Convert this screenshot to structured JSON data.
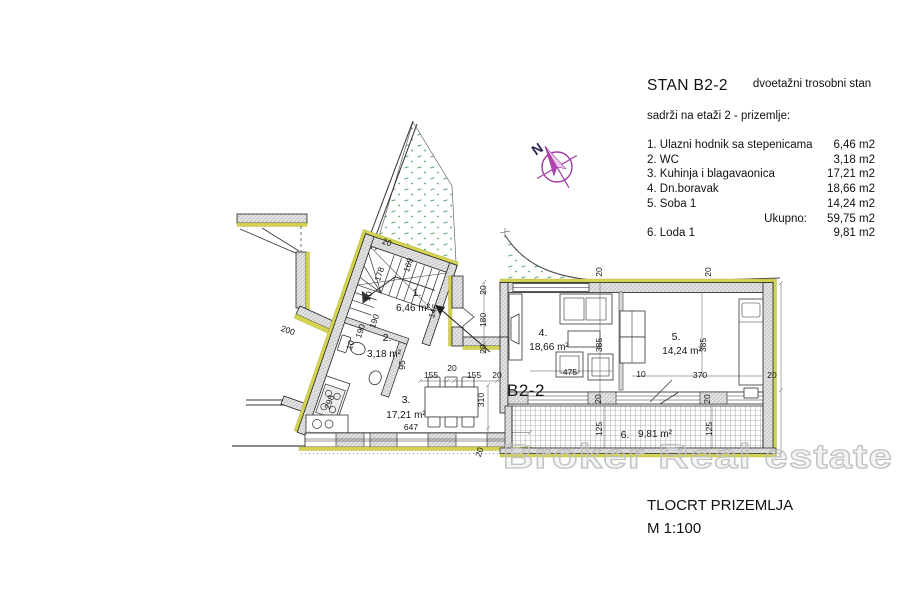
{
  "legend": {
    "title": "STAN B2-2",
    "subtitle": "dvoetažni trosobni stan",
    "intro": "sadrži na etaži 2 - prizemlje:",
    "items": [
      {
        "label": "1. Ulazni hodnik sa stepenicama",
        "mid": "",
        "area": "6,46 m2"
      },
      {
        "label": "2. WC",
        "mid": "",
        "area": "3,18 m2"
      },
      {
        "label": "3. Kuhinja i blagavaonica",
        "mid": "",
        "area": "17,21 m2"
      },
      {
        "label": "4. Dn.boravak",
        "mid": "",
        "area": "18,66 m2"
      },
      {
        "label": "5. Soba 1",
        "mid": "",
        "area": "14,24 m2"
      },
      {
        "label": "",
        "mid": "Ukupno:",
        "area": "59,75 m2"
      },
      {
        "label": "6. Loda 1",
        "mid": "",
        "area": "9,81 m2"
      }
    ]
  },
  "plan": {
    "unit_label": "B2-2",
    "compass": "N",
    "rooms": [
      {
        "num": "1.",
        "area": "6,46 m²"
      },
      {
        "num": "2.",
        "area": "3,18 m²"
      },
      {
        "num": "3.",
        "area": "17,21 m²"
      },
      {
        "num": "4.",
        "area": "18,66 m²"
      },
      {
        "num": "5.",
        "area": "14,24 m²"
      },
      {
        "num": "6.",
        "area": "9,81 m²"
      }
    ],
    "dims": [
      "20",
      "169",
      "178",
      "10",
      "190",
      "190",
      "10",
      "146",
      "95",
      "20",
      "20",
      "20",
      "180",
      "20",
      "155",
      "20",
      "155",
      "20",
      "310",
      "647",
      "475",
      "385",
      "385",
      "370",
      "10",
      "20",
      "20",
      "20",
      "125",
      "125",
      "298",
      "200",
      "20"
    ]
  },
  "watermark": "Broker Real estate",
  "footer": {
    "title": "TLOCRT PRIZEMLJA",
    "scale": "M 1:100"
  },
  "colors": {
    "accent_yellow": "#d3d34f",
    "vegetation_green": "#58a268",
    "compass_magenta": "#a23aa2",
    "wall_gray": "#e0e0e0",
    "line_dark": "#1e1e1e",
    "watermark_gray": "#c2c2c2"
  }
}
